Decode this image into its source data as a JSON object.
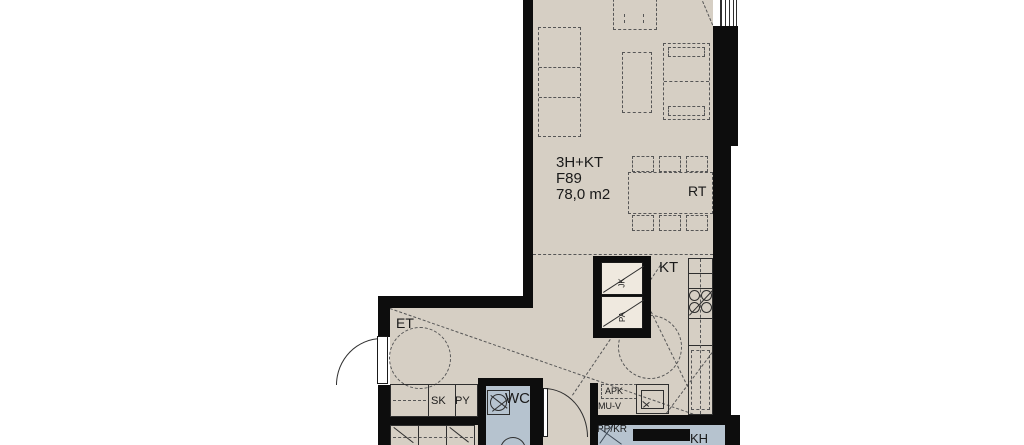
{
  "plan": {
    "unit": {
      "type": "3H+KT",
      "code": "F89",
      "area": "78,0 m2"
    },
    "room_labels": {
      "oh": "OH",
      "rt": "RT",
      "kt": "KT",
      "et": "ET",
      "wc": "WC",
      "kh": "KH"
    },
    "closet_labels": {
      "sk": "SK",
      "py": "PY"
    },
    "appliance_labels": {
      "jk": "JK",
      "pa": "PA",
      "apk": "APK",
      "muv": "MU-V",
      "ppkr": "PP/KR"
    },
    "colors": {
      "floor": "#d6cfc4",
      "wet_floor": "#b6c3cf",
      "wall": "#0d0d0d",
      "line": "#2e2e2e",
      "text": "#1a1a1a"
    }
  }
}
